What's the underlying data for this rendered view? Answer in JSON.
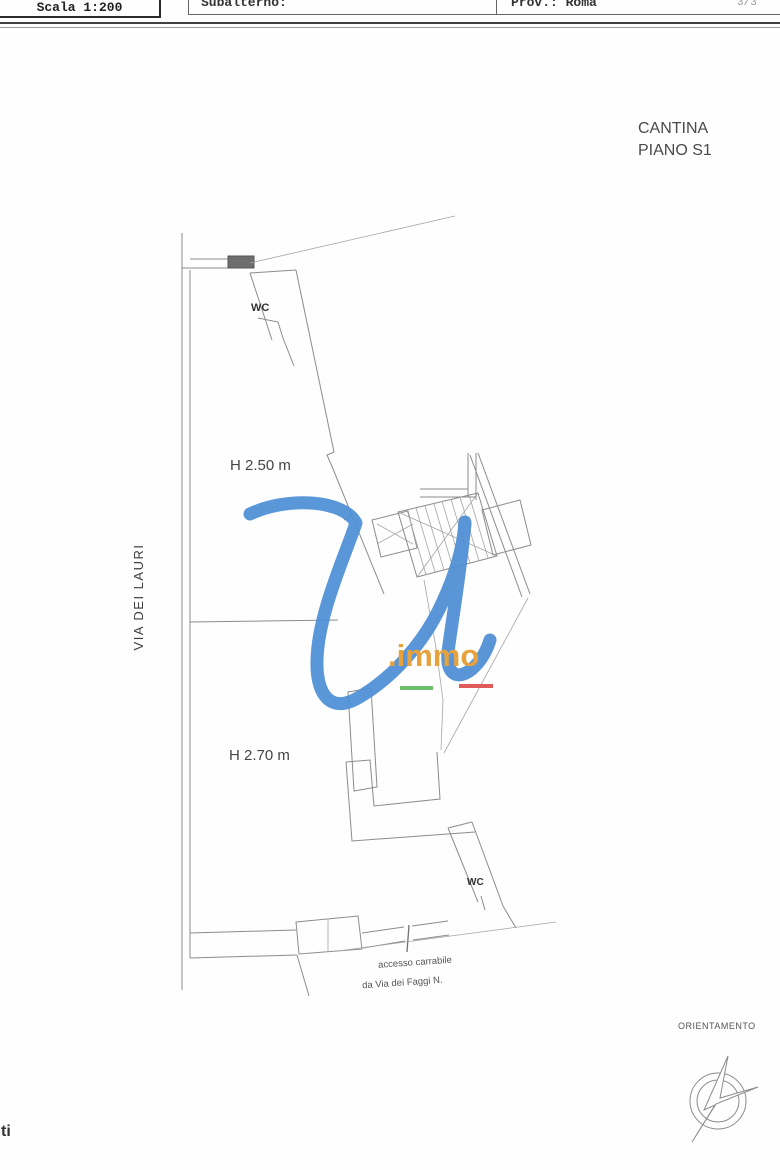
{
  "header": {
    "scale_label": "Scala 1:200",
    "subalterno_label": "Subalterno:",
    "province_label": "Prov.: Roma",
    "page_indicator": "3/3"
  },
  "plan": {
    "title_line1": "CANTINA",
    "title_line2": "PIANO S1",
    "street_name": "VIA DEI LAURI",
    "height_room_upper": "H 2.50 m",
    "height_room_lower": "H 2.70 m",
    "wc_upper": "WC",
    "wc_lower": "WC",
    "access_note_line1": "accesso carrabile",
    "access_note_line2": "da Via dei Faggi N.",
    "orientation_label": "ORIENTAMENTO"
  },
  "watermark": {
    "logo_text": ".immo",
    "blue": "#4E8FD5",
    "orange": "#E8A23C",
    "green": "#6CBF6C",
    "red": "#E05A5A"
  },
  "footer": {
    "fragment": "ti"
  }
}
